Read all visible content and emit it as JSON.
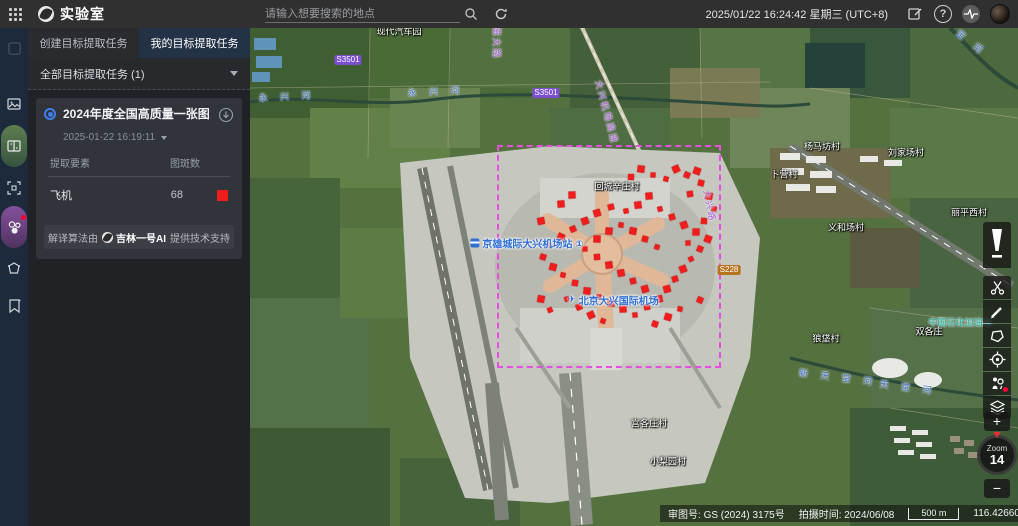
{
  "top_bar": {
    "app_title": "实验室",
    "search_placeholder": "请输入想要搜索的地点",
    "datetime": "2025/01/22 16:24:42 星期三 (UTC+8)"
  },
  "left_panel": {
    "tabs": [
      {
        "label": "创建目标提取任务"
      },
      {
        "label": "我的目标提取任务"
      }
    ],
    "filter_label": "全部目标提取任务 (1)",
    "task_card": {
      "title": "2024年度全国高质量一张图",
      "timestamp": "2025-01-22 16:19:11",
      "table": {
        "col_element": "提取要素",
        "col_count": "图斑数",
        "row_name": "飞机",
        "row_count": "68",
        "row_color": "#f11c1c"
      },
      "footer": {
        "prefix": "解译算法由",
        "brand": "吉林一号AI",
        "suffix": "提供技术支持"
      }
    }
  },
  "map": {
    "task_rect": {
      "x1": 497,
      "y1": 145,
      "x2": 721,
      "y2": 368,
      "color": "#e44fe0"
    },
    "detections": [
      [
        676,
        169
      ],
      [
        687,
        175
      ],
      [
        697,
        171
      ],
      [
        666,
        179
      ],
      [
        701,
        183
      ],
      [
        709,
        196
      ],
      [
        714,
        209
      ],
      [
        704,
        221
      ],
      [
        696,
        232
      ],
      [
        688,
        243
      ],
      [
        649,
        196
      ],
      [
        638,
        205
      ],
      [
        626,
        211
      ],
      [
        611,
        207
      ],
      [
        597,
        213
      ],
      [
        585,
        221
      ],
      [
        573,
        229
      ],
      [
        561,
        237
      ],
      [
        549,
        245
      ],
      [
        543,
        257
      ],
      [
        553,
        267
      ],
      [
        563,
        275
      ],
      [
        575,
        283
      ],
      [
        587,
        291
      ],
      [
        599,
        297
      ],
      [
        611,
        303
      ],
      [
        623,
        309
      ],
      [
        635,
        315
      ],
      [
        647,
        307
      ],
      [
        659,
        299
      ],
      [
        667,
        289
      ],
      [
        675,
        279
      ],
      [
        683,
        269
      ],
      [
        691,
        259
      ],
      [
        700,
        249
      ],
      [
        708,
        239
      ],
      [
        657,
        247
      ],
      [
        645,
        239
      ],
      [
        633,
        231
      ],
      [
        621,
        225
      ],
      [
        609,
        231
      ],
      [
        597,
        239
      ],
      [
        585,
        249
      ],
      [
        597,
        257
      ],
      [
        609,
        265
      ],
      [
        621,
        273
      ],
      [
        633,
        281
      ],
      [
        645,
        289
      ],
      [
        567,
        299
      ],
      [
        579,
        307
      ],
      [
        591,
        315
      ],
      [
        603,
        321
      ],
      [
        655,
        324
      ],
      [
        668,
        317
      ],
      [
        680,
        309
      ],
      [
        541,
        299
      ],
      [
        641,
        169
      ],
      [
        653,
        175
      ],
      [
        631,
        177
      ],
      [
        572,
        195
      ],
      [
        561,
        204
      ],
      [
        690,
        194
      ],
      [
        541,
        221
      ],
      [
        660,
        209
      ],
      [
        672,
        217
      ],
      [
        684,
        225
      ],
      [
        550,
        310
      ],
      [
        700,
        300
      ]
    ],
    "villages": [
      {
        "text": "回城辛庄村",
        "x": 617,
        "y": 186
      },
      {
        "text": "杨马坊村",
        "x": 822,
        "y": 146
      },
      {
        "text": "刘家场村",
        "x": 906,
        "y": 152
      },
      {
        "text": "卜营村",
        "x": 784,
        "y": 174
      },
      {
        "text": "义和场村",
        "x": 846,
        "y": 227
      },
      {
        "text": "丽平西村",
        "x": 969,
        "y": 212
      },
      {
        "text": "宫各庄村",
        "x": 649,
        "y": 423
      },
      {
        "text": "小梨园村",
        "x": 668,
        "y": 461
      },
      {
        "text": "狼垡村",
        "x": 826,
        "y": 338
      },
      {
        "text": "双各庄",
        "x": 929,
        "y": 331
      },
      {
        "text": "现代汽车园",
        "x": 399,
        "y": 31
      }
    ],
    "rivers": [
      {
        "text": "永 兴 河",
        "x": 287,
        "y": 96,
        "rot": -3
      },
      {
        "text": "永 兴 河",
        "x": 436,
        "y": 91,
        "rot": -3
      },
      {
        "text": "新 天 堂 河",
        "x": 838,
        "y": 377,
        "rot": 7
      },
      {
        "text": "天 堂 河",
        "x": 908,
        "y": 387,
        "rot": 7
      },
      {
        "text": "永 定 河",
        "x": 963,
        "y": 36,
        "rot": 38
      }
    ],
    "roads": [
      {
        "text": "大兴机场高速",
        "x": 607,
        "y": 112,
        "rot": 75
      },
      {
        "text": "大兴路",
        "x": 710,
        "y": 206,
        "rot": 78
      },
      {
        "text": "磁大路",
        "x": 497,
        "y": 43,
        "rot": 90
      }
    ],
    "badges": [
      {
        "text": "S3501",
        "x": 348,
        "y": 60,
        "bg": "#7c4fd0"
      },
      {
        "text": "S3501",
        "x": 546,
        "y": 93,
        "bg": "#7c4fd0"
      },
      {
        "text": "S228",
        "x": 729,
        "y": 270,
        "bg": "#b8731f"
      }
    ],
    "pois": [
      {
        "text": "京雄城际大兴机场站 ①",
        "x": 527,
        "y": 243,
        "icon": "train"
      },
      {
        "text": "北京大兴国际机场",
        "x": 613,
        "y": 300,
        "icon": "plane"
      }
    ],
    "teal_poi": {
      "text": "中国石化加油站",
      "x": 960,
      "y": 322
    }
  },
  "right_toolbar": {
    "zoom_label": "Zoom",
    "zoom_level": "14",
    "plus": "+",
    "minus": "−"
  },
  "bottom_bar": {
    "license_label": "审图号:",
    "license_value": "GS (2024) 3175号",
    "capture_label": "拍摄时间:",
    "capture_value": "2024/06/08",
    "scale_text": "500 m",
    "coordinates": "116.42660, 39.53656"
  }
}
